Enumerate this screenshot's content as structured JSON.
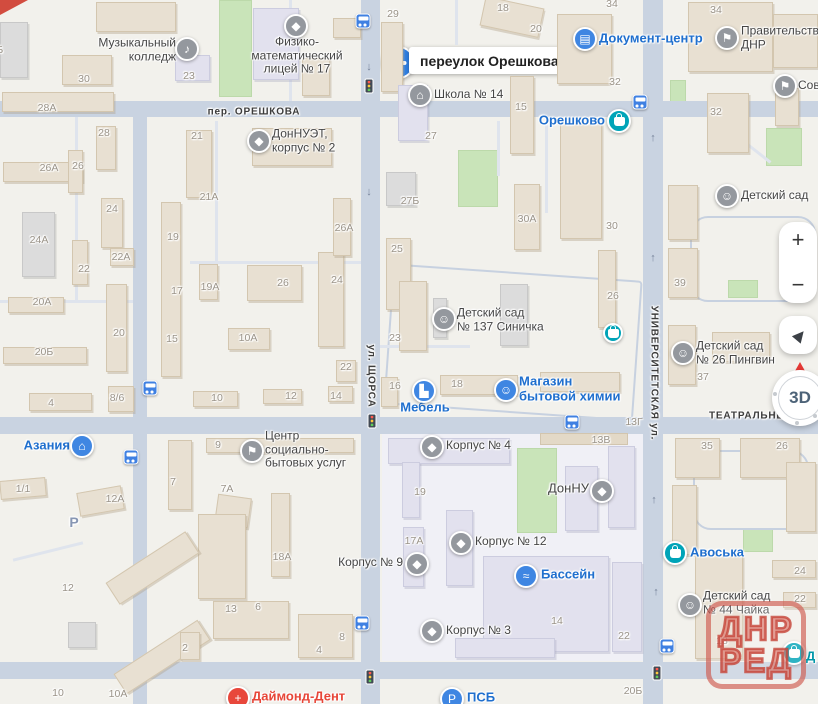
{
  "colors": {
    "land": "#f2f1ec",
    "road": "#c9d3e1",
    "green": "#c9e4b9",
    "poi_blue": "#1f6fce",
    "poi_dark": "#454545",
    "poi_red": "#e74638",
    "poi_teal": "#0097a8",
    "icon_blue": "#3f86e2",
    "icon_teal": "#00a4b8",
    "icon_grey": "#94989e",
    "number_grey": "#9a9388",
    "watermark_red": "#c5453a",
    "accent_pin": "#2f7fe3"
  },
  "callout": {
    "text": "переулок Орешкова"
  },
  "watermark": {
    "line1": "ДНР",
    "line2": "РЕД"
  },
  "controls": {
    "zoom_in": "+",
    "zoom_out": "−",
    "compass_label": "3D"
  },
  "streets": [
    {
      "name": "пер. ОРЕШКОВА",
      "x": 254,
      "y": 112,
      "o": "h"
    },
    {
      "name": "ул. ЩОРСА",
      "x": 371,
      "y": 376,
      "o": "v"
    },
    {
      "name": "УНИВЕРСИТЕТСКАЯ ул.",
      "x": 654,
      "y": 373,
      "o": "v"
    },
    {
      "name": "ТЕАТРАЛЬНЫЙ",
      "x": 752,
      "y": 416,
      "o": "h"
    }
  ],
  "parking": {
    "t": "Р",
    "x": 74,
    "y": 522
  },
  "building_numbers": [
    {
      "t": "30",
      "x": 84,
      "y": 79
    },
    {
      "t": "28А",
      "x": 47,
      "y": 108
    },
    {
      "t": "28",
      "x": 104,
      "y": 133
    },
    {
      "t": "26А",
      "x": 49,
      "y": 168
    },
    {
      "t": "26",
      "x": 78,
      "y": 166
    },
    {
      "t": "23",
      "x": 189,
      "y": 76
    },
    {
      "t": "21",
      "x": 197,
      "y": 136
    },
    {
      "t": "21А",
      "x": 209,
      "y": 197
    },
    {
      "t": "29",
      "x": 393,
      "y": 14
    },
    {
      "t": "18",
      "x": 503,
      "y": 8
    },
    {
      "t": "20",
      "x": 536,
      "y": 29
    },
    {
      "t": "34",
      "x": 612,
      "y": 4
    },
    {
      "t": "34",
      "x": 716,
      "y": 10
    },
    {
      "t": "32",
      "x": 615,
      "y": 82
    },
    {
      "t": "32",
      "x": 716,
      "y": 112
    },
    {
      "t": "15",
      "x": 521,
      "y": 107
    },
    {
      "t": "27",
      "x": 431,
      "y": 136
    },
    {
      "t": "27Б",
      "x": 410,
      "y": 201
    },
    {
      "t": "26А",
      "x": 344,
      "y": 228
    },
    {
      "t": "25",
      "x": 397,
      "y": 249
    },
    {
      "t": "24",
      "x": 337,
      "y": 280
    },
    {
      "t": "24",
      "x": 112,
      "y": 209
    },
    {
      "t": "30А",
      "x": 527,
      "y": 219
    },
    {
      "t": "30",
      "x": 612,
      "y": 226
    },
    {
      "t": "39",
      "x": 680,
      "y": 283
    },
    {
      "t": "19А",
      "x": 210,
      "y": 287
    },
    {
      "t": "26",
      "x": 283,
      "y": 283
    },
    {
      "t": "19",
      "x": 173,
      "y": 237
    },
    {
      "t": "17",
      "x": 177,
      "y": 291
    },
    {
      "t": "24А",
      "x": 39,
      "y": 240
    },
    {
      "t": "22",
      "x": 84,
      "y": 269
    },
    {
      "t": "22А",
      "x": 121,
      "y": 257
    },
    {
      "t": "20А",
      "x": 42,
      "y": 302
    },
    {
      "t": "20",
      "x": 119,
      "y": 333
    },
    {
      "t": "15",
      "x": 172,
      "y": 339
    },
    {
      "t": "20Б",
      "x": 44,
      "y": 352
    },
    {
      "t": "10А",
      "x": 248,
      "y": 338
    },
    {
      "t": "4",
      "x": 51,
      "y": 403
    },
    {
      "t": "8/6",
      "x": 117,
      "y": 398
    },
    {
      "t": "10",
      "x": 217,
      "y": 398
    },
    {
      "t": "12",
      "x": 291,
      "y": 396
    },
    {
      "t": "14",
      "x": 336,
      "y": 396
    },
    {
      "t": "22",
      "x": 346,
      "y": 367
    },
    {
      "t": "23",
      "x": 395,
      "y": 338
    },
    {
      "t": "16",
      "x": 395,
      "y": 386
    },
    {
      "t": "18",
      "x": 457,
      "y": 384
    },
    {
      "t": "26",
      "x": 613,
      "y": 296
    },
    {
      "t": "13Г",
      "x": 634,
      "y": 422
    },
    {
      "t": "13В",
      "x": 601,
      "y": 440
    },
    {
      "t": "37",
      "x": 703,
      "y": 377
    },
    {
      "t": "35",
      "x": 707,
      "y": 446
    },
    {
      "t": "26",
      "x": 782,
      "y": 446
    },
    {
      "t": "19",
      "x": 420,
      "y": 492
    },
    {
      "t": "17А",
      "x": 414,
      "y": 541
    },
    {
      "t": "14",
      "x": 557,
      "y": 621
    },
    {
      "t": "22",
      "x": 624,
      "y": 636
    },
    {
      "t": "1/1",
      "x": 23,
      "y": 489
    },
    {
      "t": "12А",
      "x": 115,
      "y": 499
    },
    {
      "t": "12",
      "x": 68,
      "y": 588
    },
    {
      "t": "10",
      "x": 58,
      "y": 693
    },
    {
      "t": "10А",
      "x": 118,
      "y": 694
    },
    {
      "t": "13",
      "x": 231,
      "y": 609
    },
    {
      "t": "6",
      "x": 258,
      "y": 607
    },
    {
      "t": "2",
      "x": 185,
      "y": 648
    },
    {
      "t": "8",
      "x": 342,
      "y": 637
    },
    {
      "t": "4",
      "x": 319,
      "y": 650
    },
    {
      "t": "24",
      "x": 800,
      "y": 571
    },
    {
      "t": "22",
      "x": 800,
      "y": 599
    },
    {
      "t": "18",
      "x": 722,
      "y": 641
    },
    {
      "t": "20Б",
      "x": 633,
      "y": 691
    },
    {
      "t": "20Б",
      "x": -6,
      "y": 50
    },
    {
      "t": "9",
      "x": 218,
      "y": 445
    },
    {
      "t": "7",
      "x": 173,
      "y": 482
    },
    {
      "t": "7А",
      "x": 227,
      "y": 489
    },
    {
      "t": "18А",
      "x": 282,
      "y": 557
    }
  ],
  "pois": [
    {
      "name": "music-college",
      "lines": [
        "Музыкальный",
        "колледж"
      ],
      "lx": 176,
      "ly": 50,
      "la": "r",
      "lc": "dark",
      "ix": 187,
      "iy": 49,
      "ic": "grey",
      "ig": "♪"
    },
    {
      "name": "fizmat-lyceum-17",
      "lines": [
        "Физико-",
        "математический",
        "лицей № 17"
      ],
      "lx": 297,
      "ly": 56,
      "la": "c",
      "lc": "dark",
      "ix": 296,
      "iy": 26,
      "ic": "grey",
      "ig": "◆"
    },
    {
      "name": "donnuet-korpus-2",
      "lines": [
        "ДонНУЭТ,",
        "корпус № 2"
      ],
      "lx": 272,
      "ly": 141,
      "la": "l",
      "lc": "dark",
      "ix": 259,
      "iy": 141,
      "ic": "grey",
      "ig": "◆"
    },
    {
      "name": "school-14",
      "lines": [
        "Школа № 14"
      ],
      "lx": 434,
      "ly": 95,
      "la": "l",
      "lc": "dark",
      "ix": 420,
      "iy": 95,
      "ic": "grey",
      "ig": "⌂"
    },
    {
      "name": "document-center",
      "lines": [
        "Документ-центр"
      ],
      "lx": 599,
      "ly": 39,
      "la": "l",
      "lc": "blue",
      "ls": 13,
      "ix": 585,
      "iy": 39,
      "ic": "blue",
      "ig": "▤"
    },
    {
      "name": "government-dnr",
      "lines": [
        "Правительство",
        "ДНР"
      ],
      "lx": 741,
      "ly": 38,
      "la": "l",
      "lc": "dark",
      "ix": 727,
      "iy": 38,
      "ic": "grey",
      "ig": "⚑"
    },
    {
      "name": "sovet",
      "lines": [
        "Сов"
      ],
      "lx": 798,
      "ly": 86,
      "la": "l",
      "lc": "dark",
      "ix": 785,
      "iy": 86,
      "ic": "grey",
      "ig": "⚑"
    },
    {
      "name": "kindergarten",
      "lines": [
        "Детский сад"
      ],
      "lx": 741,
      "ly": 196,
      "la": "l",
      "lc": "dark",
      "ix": 727,
      "iy": 196,
      "ic": "grey",
      "ig": "☺"
    },
    {
      "name": "oreshkovo-store",
      "lines": [
        "Орешково"
      ],
      "lx": 605,
      "ly": 121,
      "la": "r",
      "lc": "blue",
      "ls": 13,
      "ix": 619,
      "iy": 121,
      "ic": "teal",
      "ig": "BAG"
    },
    {
      "name": "kindergarten-137-sinichka",
      "lines": [
        "Детский сад",
        "№ 137 Синичка"
      ],
      "lx": 457,
      "ly": 320,
      "la": "l",
      "lc": "dark",
      "ix": 444,
      "iy": 319,
      "ic": "grey",
      "ig": "☺"
    },
    {
      "name": "shop-pin",
      "lines": [],
      "ix": 613,
      "iy": 333,
      "ic": "teal",
      "ig": "BAG",
      "is": 20
    },
    {
      "name": "household-chem-store",
      "lines": [
        "Магазин",
        "бытовой химии"
      ],
      "lx": 519,
      "ly": 389,
      "la": "l",
      "lc": "blue",
      "ls": 13,
      "ix": 506,
      "iy": 390,
      "ic": "blue",
      "ig": "☺"
    },
    {
      "name": "mebel",
      "lines": [
        "Мебель"
      ],
      "lx": 425,
      "ly": 408,
      "la": "c",
      "lc": "blue",
      "ls": 13,
      "ix": 424,
      "iy": 391,
      "ic": "blue",
      "ig": "▙"
    },
    {
      "name": "kindergarten-26-pingvin",
      "lines": [
        "Детский сад",
        "№ 26 Пингвин"
      ],
      "lx": 696,
      "ly": 353,
      "la": "l",
      "lc": "dark",
      "ix": 683,
      "iy": 353,
      "ic": "grey",
      "ig": "☺"
    },
    {
      "name": "azania",
      "lines": [
        "Азания"
      ],
      "lx": 70,
      "ly": 446,
      "la": "r",
      "lc": "blue",
      "ls": 13,
      "ix": 82,
      "iy": 446,
      "ic": "blue",
      "ig": "⌂"
    },
    {
      "name": "social-services-center",
      "lines": [
        "Центр",
        "социально-",
        "бытовых услуг"
      ],
      "lx": 265,
      "ly": 450,
      "la": "l",
      "lc": "dark",
      "ix": 252,
      "iy": 451,
      "ic": "grey",
      "ig": "⚑"
    },
    {
      "name": "korpus-4",
      "lines": [
        "Корпус № 4"
      ],
      "lx": 446,
      "ly": 446,
      "la": "l",
      "lc": "dark",
      "ix": 432,
      "iy": 447,
      "ic": "grey",
      "ig": "◆"
    },
    {
      "name": "donnu",
      "lines": [
        "ДонНУ"
      ],
      "lx": 589,
      "ly": 489,
      "la": "r",
      "lc": "dark",
      "ls": 13,
      "ix": 602,
      "iy": 491,
      "ic": "grey",
      "ig": "◆"
    },
    {
      "name": "korpus-12",
      "lines": [
        "Корпус № 12"
      ],
      "lx": 475,
      "ly": 542,
      "la": "l",
      "lc": "dark",
      "ix": 461,
      "iy": 543,
      "ic": "grey",
      "ig": "◆"
    },
    {
      "name": "korpus-9",
      "lines": [
        "Корпус № 9"
      ],
      "lx": 403,
      "ly": 563,
      "la": "r",
      "lc": "dark",
      "ix": 417,
      "iy": 564,
      "ic": "grey",
      "ig": "◆"
    },
    {
      "name": "bassein",
      "lines": [
        "Бассейн"
      ],
      "lx": 541,
      "ly": 575,
      "la": "l",
      "lc": "blue",
      "ls": 13,
      "ix": 526,
      "iy": 576,
      "ic": "blue",
      "ig": "≈"
    },
    {
      "name": "korpus-3",
      "lines": [
        "Корпус № 3"
      ],
      "lx": 446,
      "ly": 631,
      "la": "l",
      "lc": "dark",
      "ix": 432,
      "iy": 631,
      "ic": "grey",
      "ig": "◆"
    },
    {
      "name": "avoska",
      "lines": [
        "Авоська"
      ],
      "lx": 690,
      "ly": 553,
      "la": "l",
      "lc": "blue",
      "ls": 13,
      "ix": 675,
      "iy": 553,
      "ic": "teal",
      "ig": "BAG"
    },
    {
      "name": "kindergarten-44-chaika",
      "lines": [
        "Детский сад",
        "№ 44 Чайка"
      ],
      "lx": 703,
      "ly": 603,
      "la": "l",
      "lc": "dark",
      "ix": 690,
      "iy": 605,
      "ic": "grey",
      "ig": "☺"
    },
    {
      "name": "diamond-dent",
      "lines": [
        "Даймонд-Дент"
      ],
      "lx": 252,
      "ly": 697,
      "la": "l",
      "lc": "red",
      "ls": 13,
      "ix": 238,
      "iy": 698,
      "ic": "red",
      "ig": "+"
    },
    {
      "name": "psb",
      "lines": [
        "ПСБ"
      ],
      "lx": 467,
      "ly": 698,
      "la": "l",
      "lc": "blue",
      "ls": 13,
      "ix": 452,
      "iy": 699,
      "ic": "blue",
      "ig": "Р"
    },
    {
      "name": "d-store",
      "lines": [
        "Д"
      ],
      "lx": 806,
      "ly": 657,
      "la": "l",
      "lc": "teal",
      "ls": 13,
      "ix": 794,
      "iy": 653,
      "ic": "teal",
      "ig": "BAG"
    }
  ],
  "bus_stops": [
    [
      363,
      21
    ],
    [
      640,
      102
    ],
    [
      572,
      422
    ],
    [
      150,
      388
    ],
    [
      131,
      457
    ],
    [
      362,
      623
    ],
    [
      667,
      646
    ]
  ],
  "traffic_lights": [
    [
      369,
      86
    ],
    [
      372,
      421
    ],
    [
      370,
      677
    ],
    [
      657,
      673
    ]
  ],
  "oneway_arrows": [
    {
      "x": 369,
      "y": 67,
      "d": "↓"
    },
    {
      "x": 369,
      "y": 192,
      "d": "↓"
    },
    {
      "x": 653,
      "y": 138,
      "d": "↑"
    },
    {
      "x": 653,
      "y": 258,
      "d": "↑"
    },
    {
      "x": 654,
      "y": 500,
      "d": "↑"
    },
    {
      "x": 656,
      "y": 592,
      "d": "↑"
    }
  ]
}
